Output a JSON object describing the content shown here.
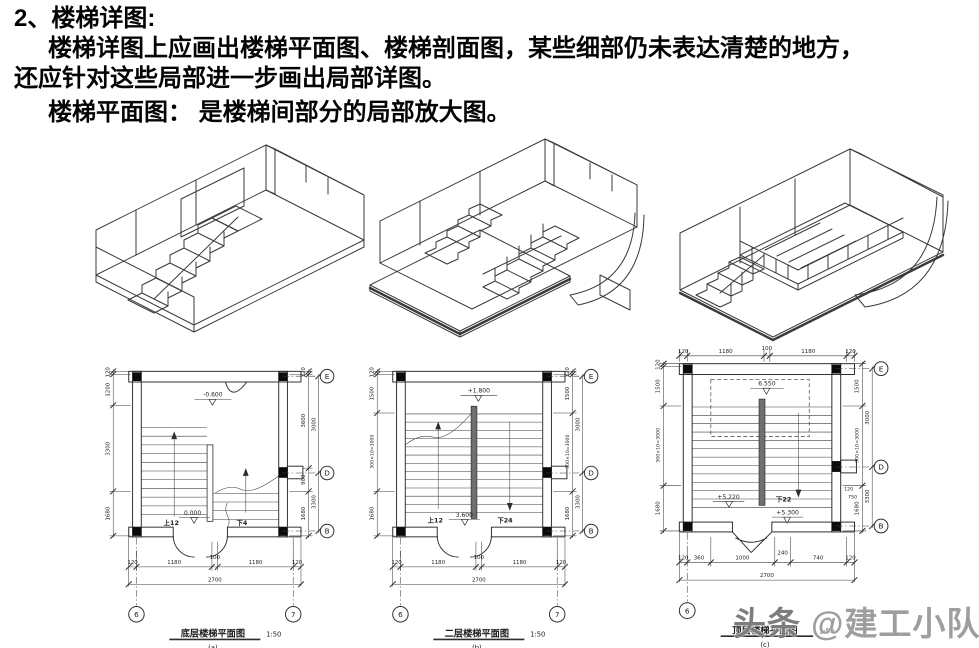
{
  "header": {
    "title": "2、楼梯详图:",
    "line2": "楼梯详图上应画出楼梯平面图、楼梯剖面图，某些细部仍未表达清楚的地方，",
    "line3": "还应针对这些局部进一步画出局部详图。",
    "line4": "楼梯平面图： 是楼梯间部分的局部放大图。"
  },
  "plans": {
    "a": {
      "caption": "底层楼梯平面图",
      "scale": "1:50",
      "tag": "(a)",
      "elev_top": "-0.600",
      "elev_door": "0.000",
      "up": "上12",
      "down": "下4",
      "bottom": [
        "120",
        "1180",
        "100",
        "1180",
        "120"
      ],
      "total": "2700",
      "left": [
        "120",
        "1200",
        "3300",
        "1680"
      ],
      "right": [
        "120",
        "3600",
        "900",
        "1680"
      ],
      "outer": [
        "3000",
        "3300"
      ],
      "grid": [
        "E",
        "D",
        "B"
      ],
      "axes": [
        "6",
        "7"
      ]
    },
    "b": {
      "caption": "二层楼梯平面图",
      "scale": "1:50",
      "tag": "(b)",
      "elev_top": "+1.800",
      "elev_door": "3.600",
      "up": "上12",
      "down": "下24",
      "bottom": [
        "120",
        "1180",
        "100",
        "1180",
        "120"
      ],
      "total": "2700",
      "left": [
        "120",
        "1500",
        "300×10=3000",
        "1680"
      ],
      "right": [
        "120",
        "1500",
        "300×10=3000",
        "1680"
      ],
      "outer": [
        "3000",
        "3300"
      ],
      "grid": [
        "E",
        "D",
        "B"
      ],
      "axes": [
        "6",
        "7"
      ]
    },
    "c": {
      "caption": "顶层楼梯平面图",
      "scale": "1:50",
      "tag": "(c)",
      "elev_top": "6.550",
      "elev_mid": "+5.220",
      "elev_door": "+5.300",
      "down": "下22",
      "top": [
        "120",
        "1180",
        "100",
        "1180",
        "120"
      ],
      "bottom": [
        "120",
        "360",
        "1000",
        "240",
        "740",
        "120"
      ],
      "total": "2700",
      "left": [
        "120",
        "1500",
        "300×10=3000",
        "1680"
      ],
      "right": [
        "1500",
        "300×10=3000",
        "1680"
      ],
      "extra": [
        "120",
        "750"
      ],
      "outer": [
        "3000",
        "3300"
      ],
      "grid": [
        "E",
        "D",
        "B"
      ],
      "axes": [
        "6"
      ]
    }
  },
  "watermark": {
    "badge": "头条",
    "handle": "@建工小队长"
  }
}
